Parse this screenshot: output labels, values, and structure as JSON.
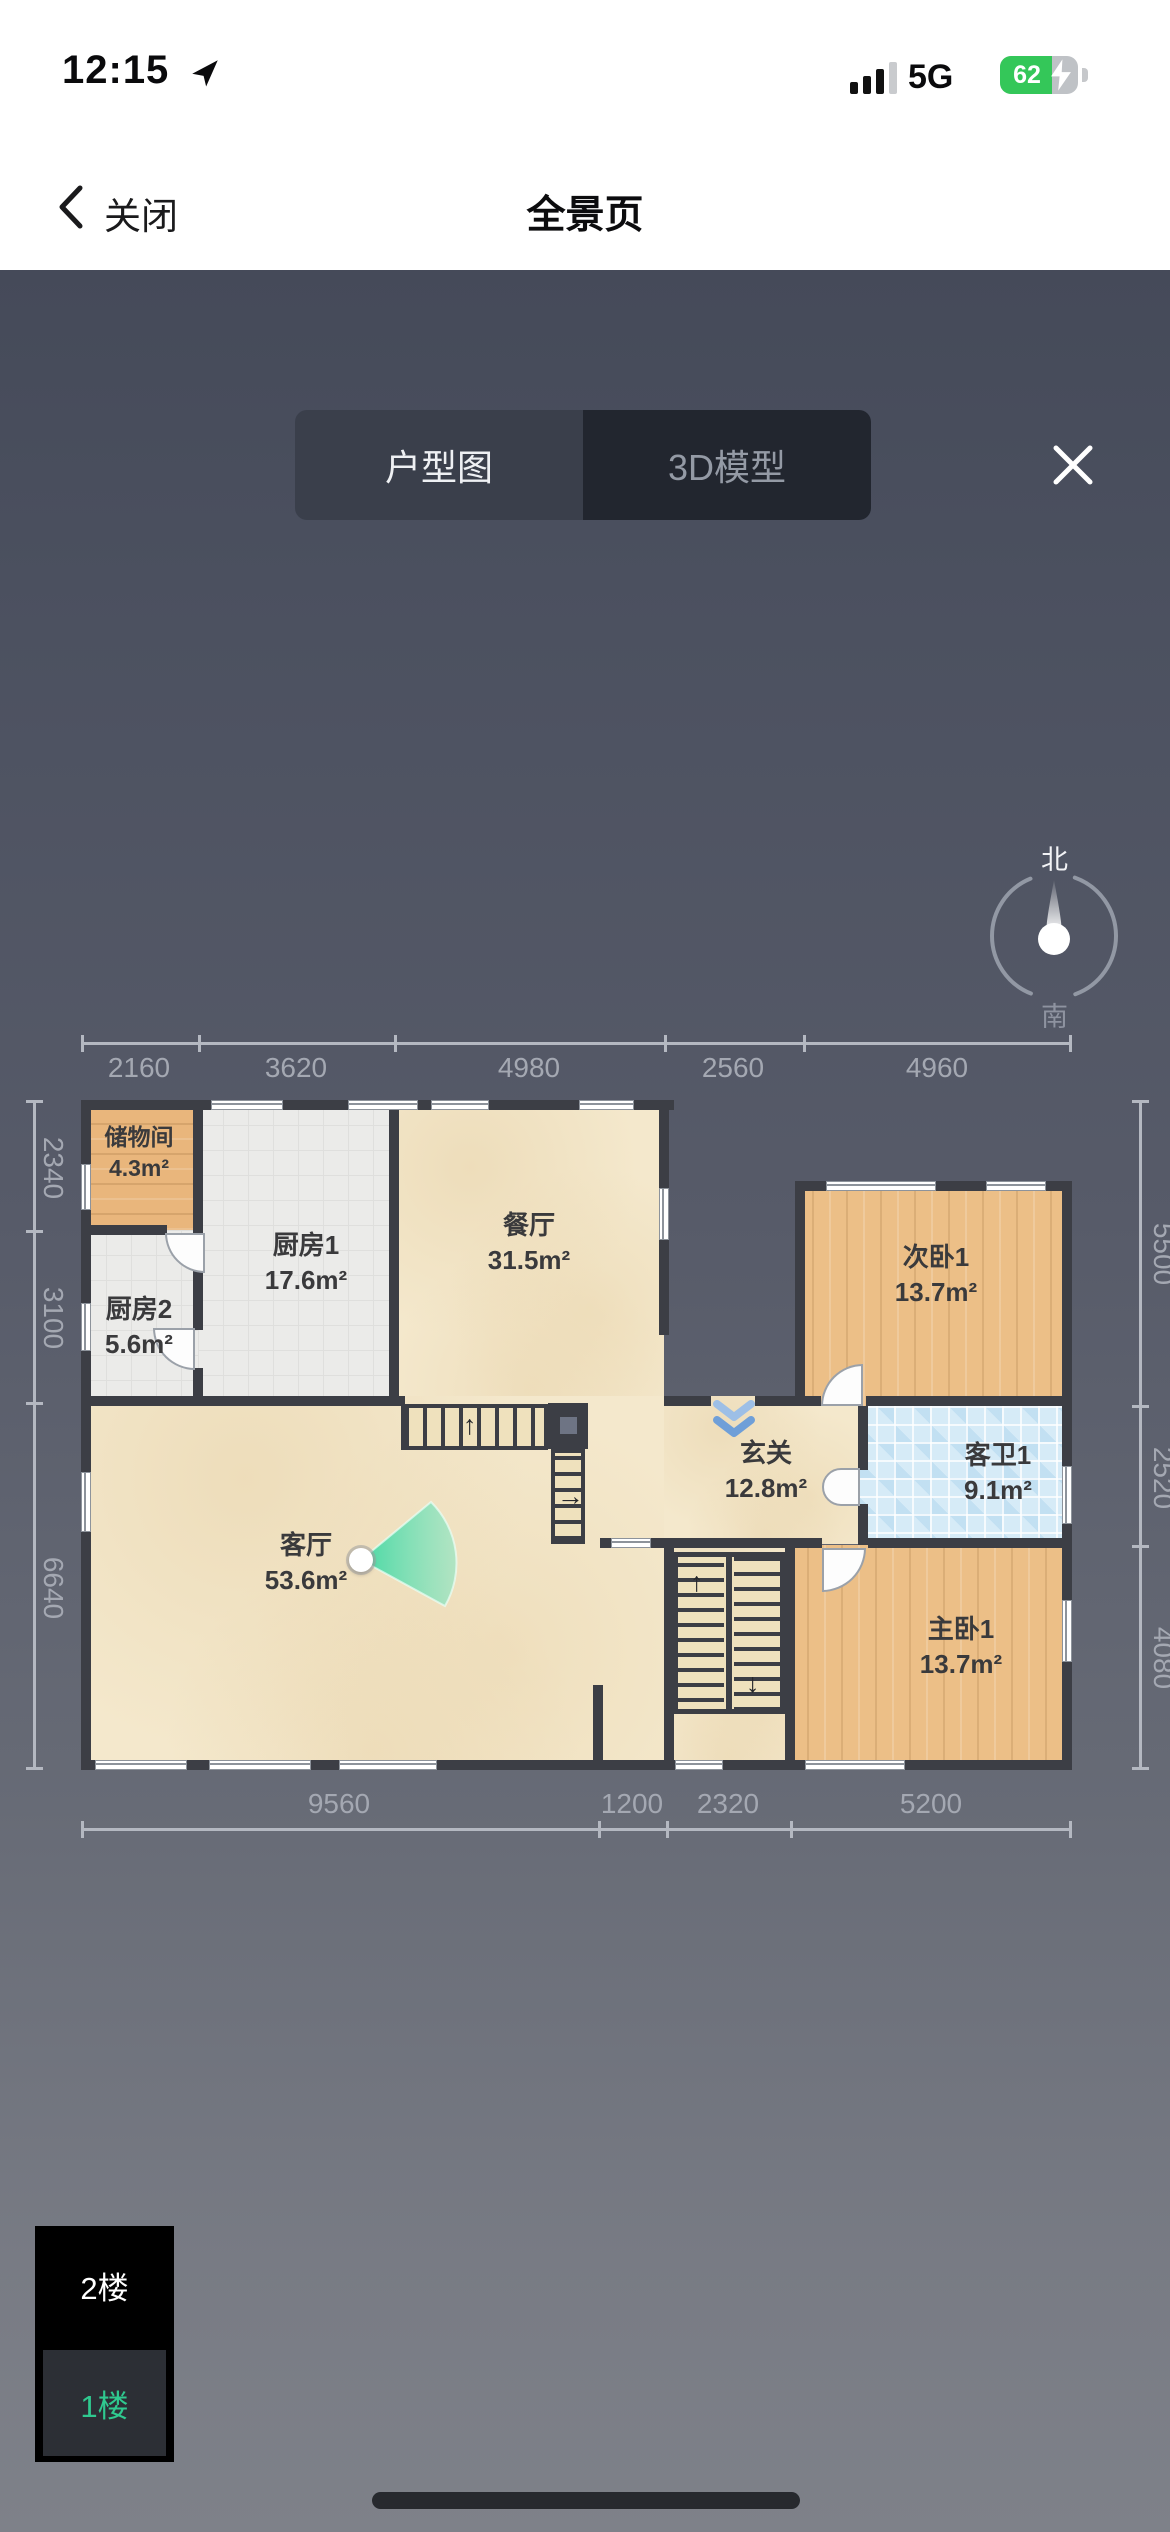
{
  "status_bar": {
    "time": "12:15",
    "network": "5G",
    "battery_percent": "62"
  },
  "nav_bar": {
    "back_label": "关闭",
    "title": "全景页"
  },
  "viewer": {
    "tabs": [
      {
        "label": "户型图"
      },
      {
        "label": "3D模型"
      }
    ],
    "selected_tab": "户型图",
    "compass": {
      "north_label": "北",
      "south_label": "南"
    }
  },
  "floor_plan": {
    "rooms": [
      {
        "name": "储物间",
        "area": "4.3m²",
        "floor": "wood"
      },
      {
        "name": "厨房1",
        "area": "17.6m²",
        "floor": "tile-gray"
      },
      {
        "name": "厨房2",
        "area": "5.6m²",
        "floor": "tile-gray"
      },
      {
        "name": "餐厅",
        "area": "31.5m²",
        "floor": "marble"
      },
      {
        "name": "客厅",
        "area": "53.6m²",
        "floor": "marble"
      },
      {
        "name": "玄关",
        "area": "12.8m²",
        "floor": "marble"
      },
      {
        "name": "次卧1",
        "area": "13.7m²",
        "floor": "wood"
      },
      {
        "name": "客卫1",
        "area": "9.1m²",
        "floor": "tile-blue"
      },
      {
        "name": "主卧1",
        "area": "13.7m²",
        "floor": "wood"
      }
    ],
    "dimensions": {
      "top": [
        "2160",
        "3620",
        "4980",
        "2560",
        "4960"
      ],
      "bottom": [
        "9560",
        "1200",
        "2320",
        "5200"
      ],
      "left": [
        "2340",
        "3100",
        "6640"
      ],
      "right": [
        "5500",
        "2520",
        "4080"
      ]
    }
  },
  "floor_selector": {
    "floors": [
      {
        "label": "2楼"
      },
      {
        "label": "1楼"
      }
    ],
    "selected": "1楼"
  },
  "icons": {
    "up_arrow": "↑",
    "down_arrow": "↓",
    "right_arrow": "→"
  },
  "colors": {
    "accent_green": "#2fc98f",
    "battery_green": "#34c759",
    "wall": "#3c3e45",
    "camera_cone": "#45d7a4"
  }
}
